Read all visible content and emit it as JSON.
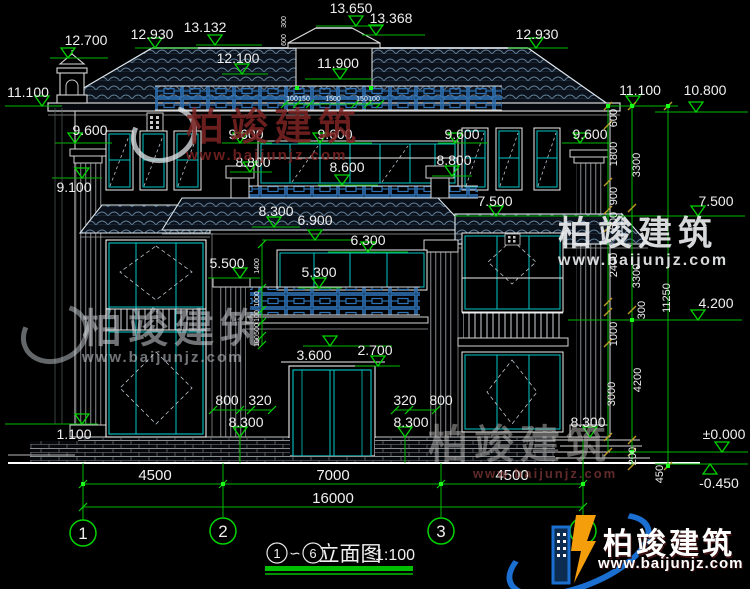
{
  "brand": {
    "name": "柏竣建筑",
    "url": "www.baijunjz.com"
  },
  "title": {
    "from": "1",
    "sep": "∽",
    "to": "6",
    "name": "立面图",
    "scale": "1:100"
  },
  "axes": [
    "1",
    "2",
    "3",
    "6"
  ],
  "levels": [
    {
      "v": "12.700"
    },
    {
      "v": "12.930"
    },
    {
      "v": "13.132"
    },
    {
      "v": "13.650"
    },
    {
      "v": "13.368"
    },
    {
      "v": "12.930"
    },
    {
      "v": "12.100"
    },
    {
      "v": "11.900"
    },
    {
      "v": "11.100"
    },
    {
      "v": "11.100"
    },
    {
      "v": "10.800"
    },
    {
      "v": "9.600"
    },
    {
      "v": "9.600"
    },
    {
      "v": "9.600"
    },
    {
      "v": "9.600"
    },
    {
      "v": "9.600"
    },
    {
      "v": "9.100"
    },
    {
      "v": "8.800"
    },
    {
      "v": "8.800"
    },
    {
      "v": "8.600"
    },
    {
      "v": "8.300"
    },
    {
      "v": "7.500"
    },
    {
      "v": "7.500"
    },
    {
      "v": "6.900"
    },
    {
      "v": "6.300"
    },
    {
      "v": "5.500"
    },
    {
      "v": "5.300"
    },
    {
      "v": "4.200"
    },
    {
      "v": "3.600"
    },
    {
      "v": "2.700"
    },
    {
      "v": "1.100"
    },
    {
      "v": "8.300"
    },
    {
      "v": "8.300"
    },
    {
      "v": "8.300"
    },
    {
      "v": "±0.000"
    },
    {
      "v": "-0.450"
    }
  ],
  "hdims": [
    "800",
    "320",
    "320",
    "800",
    "4500",
    "7000",
    "4500",
    "16000"
  ],
  "vdims": [
    "600",
    "1800",
    "900",
    "600",
    "2400",
    "300",
    "1000",
    "3000",
    "3300",
    "3300",
    "4200",
    "200",
    "450",
    "11250"
  ],
  "smalldims": [
    "300",
    "600",
    "100",
    "150",
    "1500",
    "150",
    "100",
    "1400",
    "1000",
    "100",
    "500",
    "100"
  ],
  "colors": {
    "green": "#00d400",
    "cyan": "#00c8c8",
    "blue": "#2e73b8",
    "olive": "#b89b27",
    "logo_blue": "#1a6fd0",
    "logo_orange": "#f59e0b",
    "wm_red": "#8b2f2f"
  }
}
